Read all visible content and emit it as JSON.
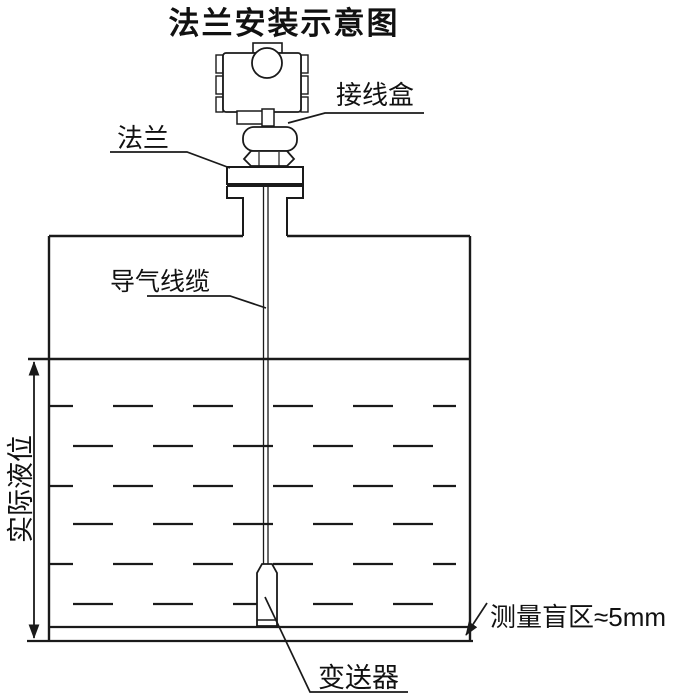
{
  "title": "法兰安装示意图",
  "labels": {
    "junction_box": "接线盒",
    "flange": "法兰",
    "air_cable": "导气线缆",
    "actual_level": "实际液位",
    "transmitter": "变送器",
    "blind_zone": "测量盲区≈5mm"
  },
  "colors": {
    "line": "#1a1a1a",
    "background": "#ffffff"
  }
}
